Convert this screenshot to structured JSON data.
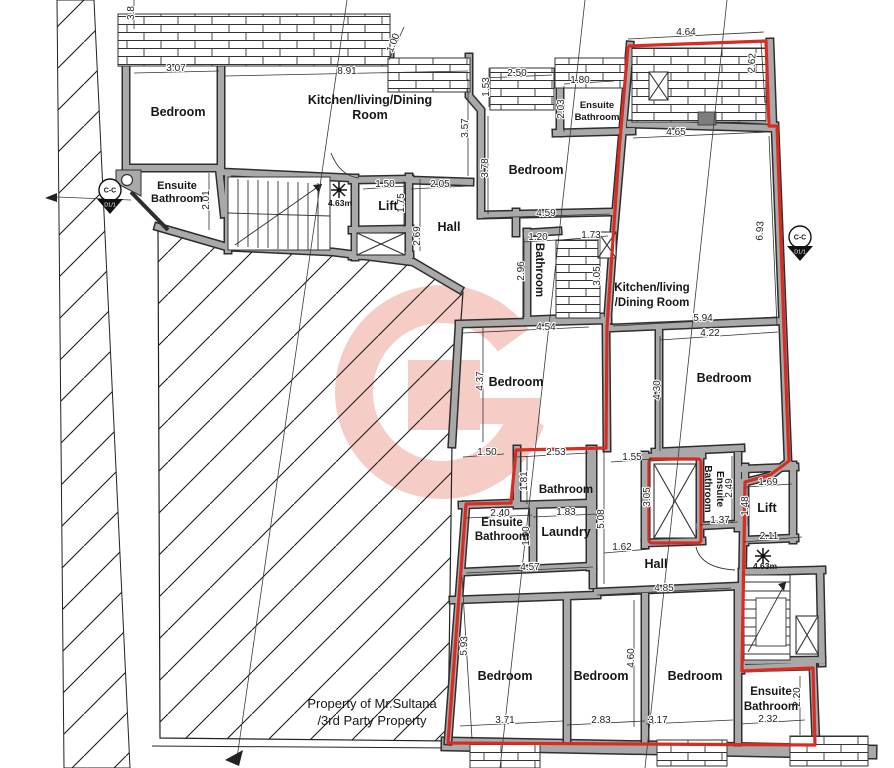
{
  "drawing": {
    "kind": "architectural floor plan"
  },
  "colors": {
    "wall_gray": "#a9a9a9",
    "wall_edge": "#2e2e2e",
    "boundary_red": "#d92b21",
    "watermark_pink": "#ea8274"
  },
  "labels": [
    {
      "n": "room-label-bedroom-1",
      "t": "Bedroom",
      "x": 178,
      "y": 116,
      "s": 12.5,
      "b": 1,
      "r": 0
    },
    {
      "n": "room-label-kitchen-1-line1",
      "t": "Kitchen/living/Dining",
      "x": 370,
      "y": 104,
      "s": 12.5,
      "b": 1,
      "r": 0
    },
    {
      "n": "room-label-kitchen-1-line2",
      "t": "Room",
      "x": 370,
      "y": 119,
      "s": 12.5,
      "b": 1,
      "r": 0
    },
    {
      "n": "room-label-ensuite-1-line1",
      "t": "Ensuite",
      "x": 177,
      "y": 189,
      "s": 11,
      "b": 1,
      "r": 0
    },
    {
      "n": "room-label-ensuite-1-line2",
      "t": "Bathroom",
      "x": 177,
      "y": 202,
      "s": 11,
      "b": 1,
      "r": 0
    },
    {
      "n": "room-label-lift-1",
      "t": "Lift",
      "x": 388,
      "y": 210,
      "s": 12.5,
      "b": 1,
      "r": 0
    },
    {
      "n": "room-label-hall-1",
      "t": "Hall",
      "x": 449,
      "y": 231,
      "s": 12.5,
      "b": 1,
      "r": 0
    },
    {
      "n": "room-label-bedroom-2",
      "t": "Bedroom",
      "x": 536,
      "y": 174,
      "s": 12.5,
      "b": 1,
      "r": 0
    },
    {
      "n": "room-label-ensuite-2-line1",
      "t": "Ensuite",
      "x": 597,
      "y": 108,
      "s": 9.5,
      "b": 1,
      "r": 0
    },
    {
      "n": "room-label-ensuite-2-line2",
      "t": "Bathroom",
      "x": 597,
      "y": 120,
      "s": 9.5,
      "b": 1,
      "r": 0
    },
    {
      "n": "room-label-bathroom-1",
      "t": "Bathroom",
      "x": 536,
      "y": 270,
      "s": 11.5,
      "b": 1,
      "r": 90
    },
    {
      "n": "room-label-kitchen-2-line1",
      "t": "Kitchen/living",
      "x": 652,
      "y": 291,
      "s": 11.5,
      "b": 1,
      "r": 0
    },
    {
      "n": "room-label-kitchen-2-line2",
      "t": "/Dining Room",
      "x": 652,
      "y": 306,
      "s": 11.5,
      "b": 1,
      "r": 0
    },
    {
      "n": "room-label-bedroom-3",
      "t": "Bedroom",
      "x": 516,
      "y": 386,
      "s": 12.5,
      "b": 1,
      "r": 0
    },
    {
      "n": "room-label-bedroom-4",
      "t": "Bedroom",
      "x": 724,
      "y": 382,
      "s": 12.5,
      "b": 1,
      "r": 0
    },
    {
      "n": "room-label-bathroom-2",
      "t": "Bathroom",
      "x": 566,
      "y": 493,
      "s": 11.5,
      "b": 1,
      "r": 0
    },
    {
      "n": "room-label-laundry",
      "t": "Laundry",
      "x": 566,
      "y": 536,
      "s": 12.5,
      "b": 1,
      "r": 0
    },
    {
      "n": "room-label-ensuite-3-line1",
      "t": "Ensuite",
      "x": 502,
      "y": 526,
      "s": 11.5,
      "b": 1,
      "r": 0
    },
    {
      "n": "room-label-ensuite-3-line2",
      "t": "Bathroom",
      "x": 502,
      "y": 540,
      "s": 11.5,
      "b": 1,
      "r": 0
    },
    {
      "n": "room-label-ensuite-4-line1",
      "t": "Ensuite",
      "x": 717,
      "y": 489,
      "s": 10,
      "b": 1,
      "r": 90
    },
    {
      "n": "room-label-ensuite-4-line2",
      "t": "Bathroom",
      "x": 705,
      "y": 489,
      "s": 10,
      "b": 1,
      "r": 90
    },
    {
      "n": "room-label-lift-2",
      "t": "Lift",
      "x": 767,
      "y": 512,
      "s": 12.5,
      "b": 1,
      "r": 0
    },
    {
      "n": "room-label-hall-2",
      "t": "Hall",
      "x": 656,
      "y": 568,
      "s": 12.5,
      "b": 1,
      "r": 0
    },
    {
      "n": "room-label-bedroom-5",
      "t": "Bedroom",
      "x": 505,
      "y": 680,
      "s": 12.5,
      "b": 1,
      "r": 0
    },
    {
      "n": "room-label-bedroom-6",
      "t": "Bedroom",
      "x": 601,
      "y": 680,
      "s": 12.5,
      "b": 1,
      "r": 0
    },
    {
      "n": "room-label-bedroom-7",
      "t": "Bedroom",
      "x": 695,
      "y": 680,
      "s": 12.5,
      "b": 1,
      "r": 0
    },
    {
      "n": "room-label-ensuite-5-line1",
      "t": "Ensuite",
      "x": 771,
      "y": 695,
      "s": 11.5,
      "b": 1,
      "r": 0
    },
    {
      "n": "room-label-ensuite-5-line2",
      "t": "Bathroom",
      "x": 771,
      "y": 710,
      "s": 11.5,
      "b": 1,
      "r": 0
    },
    {
      "n": "annotation-area-1",
      "t": "4.63m",
      "x": 340,
      "y": 206,
      "s": 8.5,
      "b": 1,
      "r": 0
    },
    {
      "n": "annotation-area-2",
      "t": "4.63m",
      "x": 765,
      "y": 569,
      "s": 8.5,
      "b": 1,
      "r": 0
    },
    {
      "n": "note-property-line1",
      "t": "Property of Mr.Sultana",
      "x": 372,
      "y": 708,
      "s": 13,
      "b": 0,
      "r": 0
    },
    {
      "n": "note-property-line2",
      "t": "/3rd Party Property",
      "x": 372,
      "y": 725,
      "s": 13,
      "b": 0,
      "r": 0
    }
  ],
  "dimensions": [
    {
      "t": "3.07",
      "x": 176,
      "y": 71,
      "r": 0,
      "l": [
        134,
        73,
        219,
        71
      ]
    },
    {
      "t": "8.91",
      "x": 347,
      "y": 74,
      "r": 0,
      "l": [
        225,
        76,
        468,
        71
      ]
    },
    {
      "t": "2.50",
      "x": 517,
      "y": 76,
      "r": 0,
      "l": [
        484,
        78,
        552,
        75
      ]
    },
    {
      "t": "1.80",
      "x": 580,
      "y": 83,
      "r": 0,
      "l": [
        564,
        84,
        614,
        81
      ]
    },
    {
      "t": "4.64",
      "x": 686,
      "y": 35,
      "r": 0,
      "l": [
        628,
        39,
        764,
        32
      ]
    },
    {
      "t": "2.62",
      "x": 755,
      "y": 63,
      "r": -87,
      "l": [
        761,
        42,
        765,
        103
      ]
    },
    {
      "t": "4.65",
      "x": 676,
      "y": 135,
      "r": 0,
      "l": [
        633,
        138,
        767,
        132
      ]
    },
    {
      "t": "1.00",
      "x": 396,
      "y": 44,
      "r": -68,
      "l": [
        389,
        60,
        404,
        27
      ]
    },
    {
      "t": "1.53",
      "x": 489,
      "y": 87,
      "r": -90,
      "l": [
        489,
        68,
        489,
        107
      ]
    },
    {
      "t": "2.03",
      "x": 564,
      "y": 109,
      "r": -90,
      "l": [
        564,
        86,
        564,
        132
      ]
    },
    {
      "t": "3.57",
      "x": 468,
      "y": 128,
      "r": -90,
      "l": [
        468,
        79,
        468,
        176
      ]
    },
    {
      "t": "3.78",
      "x": 488,
      "y": 168,
      "r": -90,
      "l": [
        488,
        116,
        488,
        214
      ]
    },
    {
      "t": "1.50",
      "x": 385,
      "y": 187,
      "r": 0,
      "l": [
        363,
        189,
        406,
        186
      ]
    },
    {
      "t": "2.05",
      "x": 440,
      "y": 187,
      "r": 0,
      "l": [
        411,
        189,
        468,
        186
      ]
    },
    {
      "t": "1.75",
      "x": 404,
      "y": 203,
      "r": -90,
      "l": [
        404,
        181,
        404,
        227
      ]
    },
    {
      "t": "2.69",
      "x": 420,
      "y": 236,
      "r": -90,
      "l": [
        420,
        179,
        420,
        251
      ]
    },
    {
      "t": "2.01",
      "x": 209,
      "y": 200,
      "r": -90,
      "l": [
        209,
        173,
        209,
        230
      ]
    },
    {
      "t": "4.59",
      "x": 546,
      "y": 216,
      "r": 0,
      "l": [
        483,
        218,
        610,
        214
      ]
    },
    {
      "t": "1.20",
      "x": 538,
      "y": 240,
      "r": 0,
      "l": [
        523,
        242,
        557,
        240
      ]
    },
    {
      "t": "1.73",
      "x": 591,
      "y": 238,
      "r": 0,
      "l": [
        560,
        240,
        608,
        236
      ]
    },
    {
      "t": "2.96",
      "x": 524,
      "y": 271,
      "r": -90,
      "l": [
        524,
        238,
        524,
        317
      ]
    },
    {
      "t": "3.05",
      "x": 600,
      "y": 276,
      "r": -90,
      "l": [
        600,
        236,
        600,
        319
      ]
    },
    {
      "t": "5.94",
      "x": 703,
      "y": 321,
      "r": 0,
      "l": [
        613,
        326,
        776,
        317
      ]
    },
    {
      "t": "6.93",
      "x": 763,
      "y": 231,
      "r": -87,
      "l": [
        769,
        136,
        777,
        326
      ]
    },
    {
      "t": "4.22",
      "x": 710,
      "y": 336,
      "r": 0,
      "l": [
        660,
        340,
        778,
        332
      ]
    },
    {
      "t": "4.30",
      "x": 660,
      "y": 390,
      "r": -90,
      "l": [
        660,
        336,
        660,
        451
      ]
    },
    {
      "t": "4.54",
      "x": 546,
      "y": 330,
      "r": 0,
      "l": [
        463,
        333,
        589,
        327
      ]
    },
    {
      "t": "4.37",
      "x": 483,
      "y": 381,
      "r": -90,
      "l": [
        483,
        327,
        483,
        442
      ]
    },
    {
      "t": "1.50",
      "x": 487,
      "y": 455,
      "r": 0,
      "l": [
        463,
        457,
        504,
        454
      ]
    },
    {
      "t": "2.53",
      "x": 556,
      "y": 455,
      "r": 0,
      "l": [
        517,
        457,
        588,
        453
      ]
    },
    {
      "t": "1.81",
      "x": 527,
      "y": 481,
      "r": -90,
      "l": [
        527,
        456,
        527,
        504
      ]
    },
    {
      "t": "1.55",
      "x": 632,
      "y": 460,
      "r": 0,
      "l": [
        611,
        462,
        652,
        459
      ]
    },
    {
      "t": "2.40",
      "x": 500,
      "y": 516,
      "r": 0,
      "l": [
        466,
        518,
        532,
        515
      ]
    },
    {
      "t": "1.83",
      "x": 566,
      "y": 515,
      "r": 0,
      "l": [
        533,
        517,
        598,
        514
      ]
    },
    {
      "t": "1.90",
      "x": 529,
      "y": 536,
      "r": -90,
      "l": [
        529,
        510,
        529,
        561
      ]
    },
    {
      "t": "5.08",
      "x": 604,
      "y": 519,
      "r": -90,
      "l": [
        604,
        449,
        604,
        584
      ]
    },
    {
      "t": "4.57",
      "x": 530,
      "y": 570,
      "r": 0,
      "l": [
        466,
        573,
        593,
        567
      ]
    },
    {
      "t": "1.62",
      "x": 622,
      "y": 550,
      "r": 0,
      "l": [
        604,
        553,
        650,
        549
      ]
    },
    {
      "t": "3.05",
      "x": 650,
      "y": 497,
      "r": -90,
      "l": [
        650,
        457,
        650,
        540
      ]
    },
    {
      "t": "1.69",
      "x": 768,
      "y": 485,
      "r": 0,
      "l": [
        746,
        487,
        792,
        484
      ]
    },
    {
      "t": "2.49",
      "x": 732,
      "y": 488,
      "r": -90,
      "l": [
        732,
        456,
        732,
        523
      ]
    },
    {
      "t": "1.48",
      "x": 748,
      "y": 506,
      "r": -90,
      "l": [
        748,
        487,
        748,
        526
      ]
    },
    {
      "t": "1.37",
      "x": 720,
      "y": 523,
      "r": 0,
      "l": [
        700,
        525,
        738,
        522
      ]
    },
    {
      "t": "2.11",
      "x": 769,
      "y": 539,
      "r": 0,
      "l": [
        744,
        542,
        802,
        537
      ]
    },
    {
      "t": "4.85",
      "x": 664,
      "y": 591,
      "r": 0,
      "l": [
        597,
        595,
        731,
        588
      ]
    },
    {
      "t": "5.93",
      "x": 467,
      "y": 646,
      "r": -88,
      "l": [
        462,
        577,
        472,
        739
      ]
    },
    {
      "t": "4.60",
      "x": 634,
      "y": 658,
      "r": -90,
      "l": [
        634,
        600,
        634,
        727
      ]
    },
    {
      "t": "3.71",
      "x": 505,
      "y": 723,
      "r": 0,
      "l": [
        460,
        726,
        563,
        721
      ]
    },
    {
      "t": "2.83",
      "x": 601,
      "y": 723,
      "r": 0,
      "l": [
        567,
        725,
        645,
        721
      ]
    },
    {
      "t": "3.17",
      "x": 658,
      "y": 723,
      "r": 0,
      "l": [
        646,
        724,
        733,
        720
      ]
    },
    {
      "t": "2.32",
      "x": 768,
      "y": 722,
      "r": 0,
      "l": [
        741,
        724,
        805,
        720
      ]
    },
    {
      "t": "2.20",
      "x": 800,
      "y": 697,
      "r": -90,
      "l": [
        800,
        676,
        800,
        735
      ]
    },
    {
      "t": "3.8",
      "x": 134,
      "y": 13,
      "r": -90,
      "l": [
        134,
        0,
        134,
        29
      ]
    }
  ],
  "markers": [
    {
      "top": "C-C",
      "bottom": "D1/1",
      "x": 110,
      "y": 190
    },
    {
      "top": "C-C",
      "bottom": "D1/1",
      "x": 800,
      "y": 237
    }
  ]
}
